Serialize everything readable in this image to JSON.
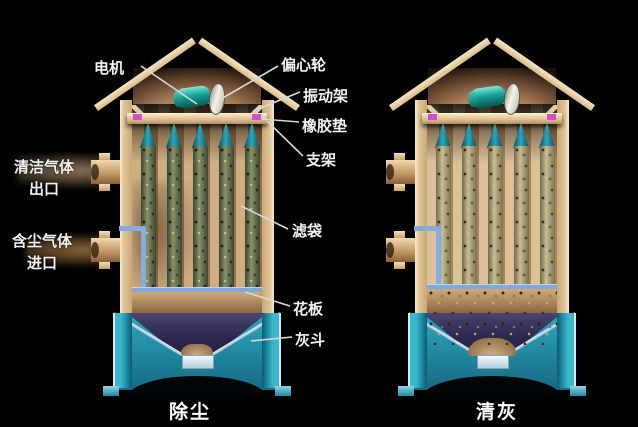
{
  "labels": {
    "motor": "电机",
    "eccentric_wheel": "偏心轮",
    "vibration_frame": "振动架",
    "rubber_pad": "橡胶垫",
    "support_frame": "支架",
    "filter_bag": "滤袋",
    "perforated_plate": "花板",
    "ash_hopper": "灰斗",
    "clean_gas_outlet_line1": "清洁气体",
    "clean_gas_outlet_line2": "出口",
    "dusty_gas_inlet_line1": "含尘气体",
    "dusty_gas_inlet_line2": "进口"
  },
  "captions": {
    "left_mode": "除尘",
    "right_mode": "清灰"
  },
  "colors": {
    "background": "#000000",
    "housing_tan": "#e2c698",
    "motor_teal": "#14a096",
    "eccentric_wheel_white": "#f4f4ea",
    "rubber_pad_magenta": "#cf4fd0",
    "bag_cap_teal": "#2da4b6",
    "dirty_bag_olive": "#6f764a",
    "clean_bag_tan": "#b5a87c",
    "hopper_cyan": "#2fa8c0",
    "hopper_cone_navy": "#2c2850",
    "duct_blue": "#86abdf",
    "label_text": "#f2f2f2"
  }
}
